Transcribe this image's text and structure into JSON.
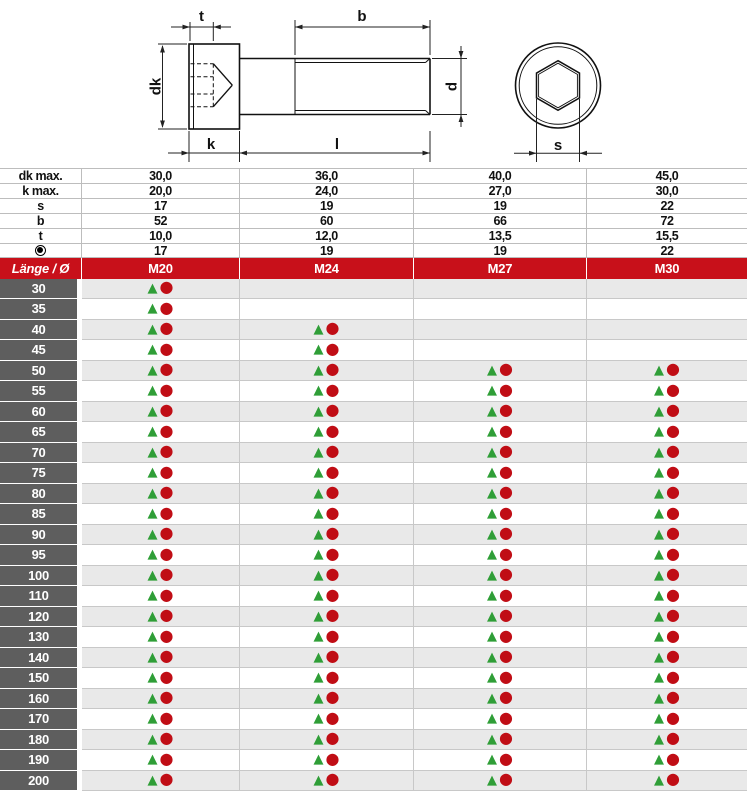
{
  "colors": {
    "accent-red": "#c8101a",
    "symbol-red": "#c00d15",
    "green": "#2f9e37",
    "row-label-gray": "#5e5e5e",
    "stripe-gray": "#e9e9e9",
    "grid-line": "#c8c8c8",
    "spec-line": "#bdbdbd",
    "text-dark": "#111111"
  },
  "drawing": {
    "labels": {
      "t": "t",
      "b": "b",
      "dk": "dk",
      "d": "d",
      "k": "k",
      "l": "l",
      "s": "s"
    }
  },
  "specs": {
    "rows": [
      {
        "label": "dk max.",
        "values": [
          "30,0",
          "36,0",
          "40,0",
          "45,0"
        ]
      },
      {
        "label": "k max.",
        "values": [
          "20,0",
          "24,0",
          "27,0",
          "30,0"
        ]
      },
      {
        "label": "s",
        "values": [
          "17",
          "19",
          "19",
          "22"
        ]
      },
      {
        "label": "b",
        "values": [
          "52",
          "60",
          "66",
          "72"
        ]
      },
      {
        "label": "t",
        "values": [
          "10,0",
          "12,0",
          "13,5",
          "15,5"
        ]
      },
      {
        "icon": "socket-icon",
        "values": [
          "17",
          "19",
          "19",
          "22"
        ]
      }
    ]
  },
  "header": {
    "label": "Länge / Ø",
    "columns": [
      "M20",
      "M24",
      "M27",
      "M30"
    ]
  },
  "symbols": {
    "triangle_glyph": "▲",
    "circle_glyph": "●",
    "triangle_color": "#2f9e37",
    "circle_color": "#c00d15"
  },
  "body": {
    "rows": [
      {
        "length": "30",
        "available": [
          true,
          false,
          false,
          false
        ]
      },
      {
        "length": "35",
        "available": [
          true,
          false,
          false,
          false
        ]
      },
      {
        "length": "40",
        "available": [
          true,
          true,
          false,
          false
        ]
      },
      {
        "length": "45",
        "available": [
          true,
          true,
          false,
          false
        ]
      },
      {
        "length": "50",
        "available": [
          true,
          true,
          true,
          true
        ]
      },
      {
        "length": "55",
        "available": [
          true,
          true,
          true,
          true
        ]
      },
      {
        "length": "60",
        "available": [
          true,
          true,
          true,
          true
        ]
      },
      {
        "length": "65",
        "available": [
          true,
          true,
          true,
          true
        ]
      },
      {
        "length": "70",
        "available": [
          true,
          true,
          true,
          true
        ]
      },
      {
        "length": "75",
        "available": [
          true,
          true,
          true,
          true
        ]
      },
      {
        "length": "80",
        "available": [
          true,
          true,
          true,
          true
        ]
      },
      {
        "length": "85",
        "available": [
          true,
          true,
          true,
          true
        ]
      },
      {
        "length": "90",
        "available": [
          true,
          true,
          true,
          true
        ]
      },
      {
        "length": "95",
        "available": [
          true,
          true,
          true,
          true
        ]
      },
      {
        "length": "100",
        "available": [
          true,
          true,
          true,
          true
        ]
      },
      {
        "length": "110",
        "available": [
          true,
          true,
          true,
          true
        ]
      },
      {
        "length": "120",
        "available": [
          true,
          true,
          true,
          true
        ]
      },
      {
        "length": "130",
        "available": [
          true,
          true,
          true,
          true
        ]
      },
      {
        "length": "140",
        "available": [
          true,
          true,
          true,
          true
        ]
      },
      {
        "length": "150",
        "available": [
          true,
          true,
          true,
          true
        ]
      },
      {
        "length": "160",
        "available": [
          true,
          true,
          true,
          true
        ]
      },
      {
        "length": "170",
        "available": [
          true,
          true,
          true,
          true
        ]
      },
      {
        "length": "180",
        "available": [
          true,
          true,
          true,
          true
        ]
      },
      {
        "length": "190",
        "available": [
          true,
          true,
          true,
          true
        ]
      },
      {
        "length": "200",
        "available": [
          true,
          true,
          true,
          true
        ]
      }
    ]
  }
}
